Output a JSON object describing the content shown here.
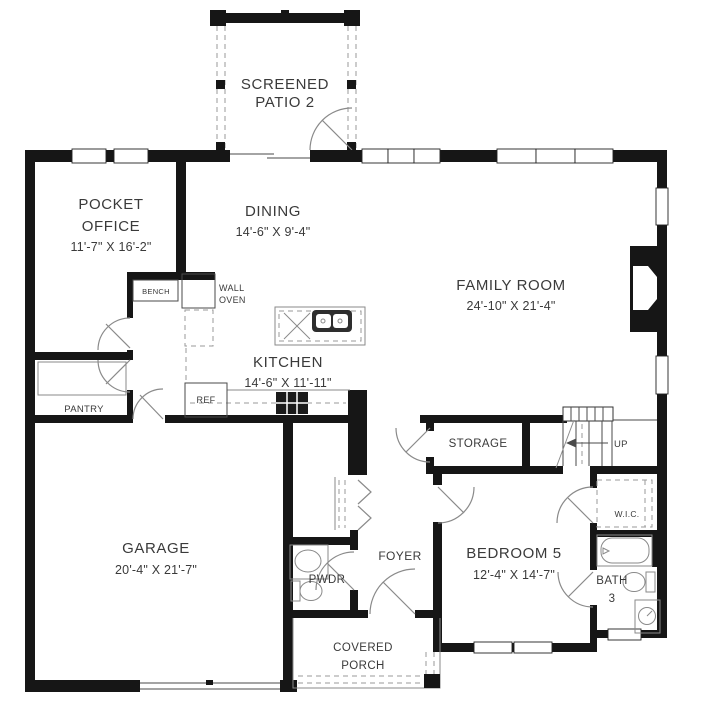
{
  "plan_title": "First floor plan",
  "colors": {
    "wall": "#161616",
    "text": "#3a3a3a",
    "background": "#ffffff",
    "fixture_line": "#8a8a8a"
  },
  "rooms": {
    "screened_patio": {
      "line1": "SCREENED",
      "line2": "PATIO 2"
    },
    "pocket_office": {
      "line1": "POCKET",
      "line2": "OFFICE",
      "dim": "11'-7\" X 16'-2\""
    },
    "dining": {
      "name": "DINING",
      "dim": "14'-6\" X 9'-4\""
    },
    "family_room": {
      "name": "FAMILY ROOM",
      "dim": "24'-10\" X 21'-4\""
    },
    "kitchen": {
      "name": "KITCHEN",
      "dim": "14'-6\" X 11'-11\""
    },
    "garage": {
      "name": "GARAGE",
      "dim": "20'-4\" X 21'-7\""
    },
    "storage": {
      "name": "STORAGE"
    },
    "foyer": {
      "name": "FOYER"
    },
    "pwdr": {
      "name": "PWDR"
    },
    "pantry": {
      "name": "PANTRY"
    },
    "bedroom5": {
      "name": "BEDROOM 5",
      "dim": "12'-4\" X 14'-7\""
    },
    "wic": {
      "name": "W.I.C."
    },
    "bath3": {
      "line1": "BATH",
      "line2": "3"
    },
    "covered_porch": {
      "line1": "COVERED",
      "line2": "PORCH"
    }
  },
  "fixtures": {
    "bench": "BENCH",
    "wall_oven_line1": "WALL",
    "wall_oven_line2": "OVEN",
    "ref": "REF",
    "stairs_up": "UP"
  }
}
